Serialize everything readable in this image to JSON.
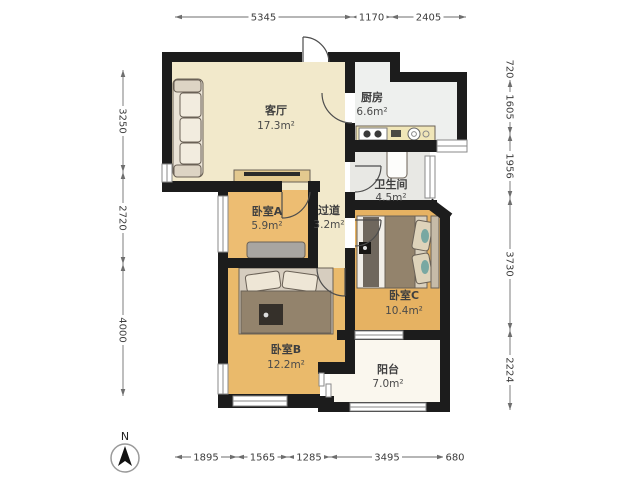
{
  "compass": {
    "label": "N"
  },
  "rooms": {
    "living": {
      "name": "客厅",
      "area": "17.3m²"
    },
    "kitchen": {
      "name": "厨房",
      "area": "6.6m²"
    },
    "bathroom": {
      "name": "卫生间",
      "area": "4.5m²"
    },
    "bedroomA": {
      "name": "卧室A",
      "area": "5.9m²"
    },
    "corridor": {
      "name": "过道",
      "area": "3.2m²"
    },
    "bedroomB": {
      "name": "卧室B",
      "area": "12.2m²"
    },
    "bedroomC": {
      "name": "卧室C",
      "area": "10.4m²"
    },
    "balcony": {
      "name": "阳台",
      "area": "7.0m²"
    }
  },
  "dims": {
    "top": [
      "5345",
      "1170",
      "2405"
    ],
    "bottom": [
      "1895",
      "1565",
      "1285",
      "3495",
      "680"
    ],
    "left": [
      "3250",
      "2720",
      "4000"
    ],
    "right": [
      "720",
      "1605",
      "1956",
      "3730",
      "2224"
    ]
  },
  "colors": {
    "wall": "#1c1c1c",
    "floor_living": "#f2e9cb",
    "floor_kitchen": "#eef0ee",
    "floor_bath": "#e8e8e4",
    "floor_balcony": "#faf7ee",
    "floor_bedroom_a": "#edbd72",
    "floor_bedroom_b": "#eaba6b",
    "floor_bedroom_c": "#e6b262",
    "dim_line": "#6e6e6e",
    "dim_text": "#3c3c3c"
  }
}
